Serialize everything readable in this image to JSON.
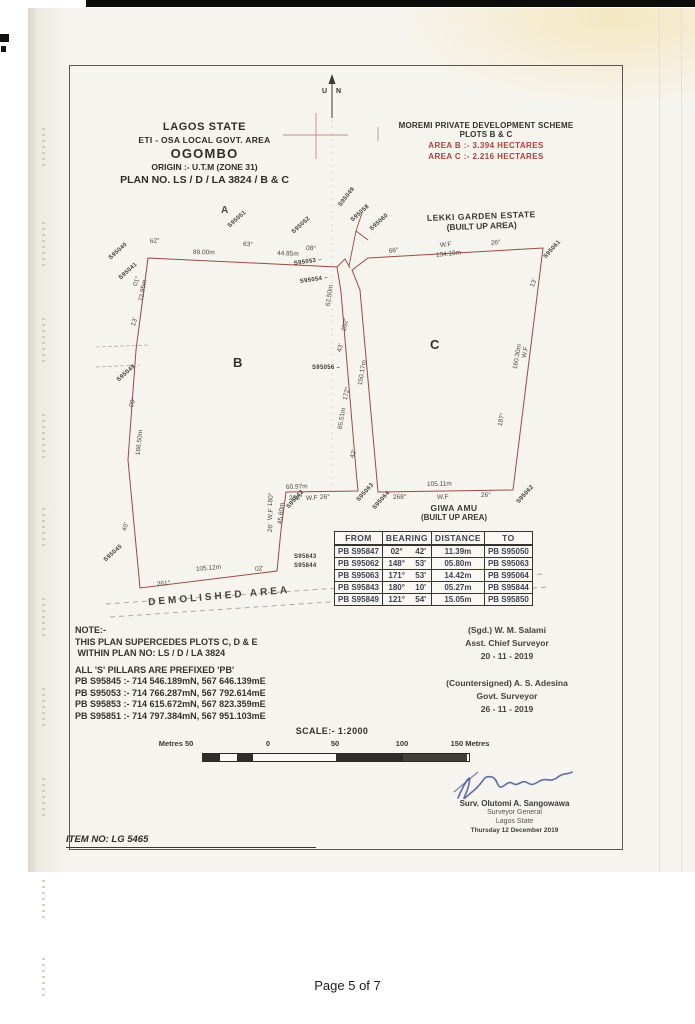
{
  "page": {
    "footer": "Page 5 of 7",
    "item_no": "ITEM NO: LG 5465"
  },
  "header_left": {
    "lines": [
      "LAGOS STATE",
      "ETI - OSA  LOCAL GOVT. AREA",
      "OGOMBO",
      "ORIGIN :- U.T.M (ZONE 31)",
      "PLAN NO. LS / D / LA 3824 / B & C"
    ]
  },
  "header_right": {
    "line1": "MOREMI PRIVATE DEVELOPMENT SCHEME",
    "line2": "PLOTS B & C",
    "area_b": "AREA  B :- 3.394 HECTARES",
    "area_c": "AREA  C :- 2.216 HECTARES",
    "red_color": "#b0413a"
  },
  "north": {
    "u": "U",
    "n": "N"
  },
  "map": {
    "plot_b": "B",
    "plot_c": "C",
    "estate_line1": "LEKKI GARDEN ESTATE",
    "estate_line2": "(BUILT UP AREA)",
    "giwa_line1": "GIWA AMU",
    "giwa_line2": "(BUILT UP AREA)",
    "demolished": "DEMOLISHED  AREA",
    "line_color": "#9b4a42",
    "labels": [
      {
        "t": "A",
        "x": 221,
        "y": 206,
        "r": 0,
        "f": 10,
        "b": 1
      },
      {
        "t": "62°",
        "x": 150,
        "y": 239,
        "r": -4
      },
      {
        "t": "89.00m",
        "x": 193,
        "y": 250,
        "r": 1
      },
      {
        "t": "63°",
        "x": 243,
        "y": 242,
        "r": 2
      },
      {
        "t": "44.85m",
        "x": 277,
        "y": 251,
        "r": 2
      },
      {
        "t": "08°",
        "x": 306,
        "y": 246,
        "r": 2
      },
      {
        "t": "S95051",
        "x": 229,
        "y": 224,
        "r": -42,
        "p": 1
      },
      {
        "t": "S95052",
        "x": 293,
        "y": 230,
        "r": -42,
        "p": 1
      },
      {
        "t": "S95049",
        "x": 340,
        "y": 203,
        "r": -52,
        "p": 1
      },
      {
        "t": "S95058",
        "x": 352,
        "y": 218,
        "r": -42,
        "p": 1
      },
      {
        "t": "S95053 –",
        "x": 294,
        "y": 261,
        "r": -8,
        "p": 1
      },
      {
        "t": "S95054 –",
        "x": 300,
        "y": 279,
        "r": -8,
        "p": 1
      },
      {
        "t": "S95060",
        "x": 371,
        "y": 227,
        "r": -42,
        "p": 1
      },
      {
        "t": "S95061",
        "x": 545,
        "y": 255,
        "r": -48,
        "p": 1
      },
      {
        "t": "S95040",
        "x": 110,
        "y": 256,
        "r": -42,
        "p": 1
      },
      {
        "t": "S95041",
        "x": 120,
        "y": 276,
        "r": -42,
        "p": 1
      },
      {
        "t": "01°",
        "x": 136,
        "y": 283,
        "r": -72
      },
      {
        "t": "72.95m",
        "x": 142,
        "y": 298,
        "r": -80
      },
      {
        "t": "13'",
        "x": 134,
        "y": 323,
        "r": -72
      },
      {
        "t": "S95049",
        "x": 118,
        "y": 378,
        "r": -42,
        "p": 1
      },
      {
        "t": "00'",
        "x": 132,
        "y": 404,
        "r": -72
      },
      {
        "t": "166.50m",
        "x": 139,
        "y": 452,
        "r": -84
      },
      {
        "t": "40'",
        "x": 125,
        "y": 528,
        "r": -72
      },
      {
        "t": "S95045",
        "x": 105,
        "y": 558,
        "r": -42,
        "p": 1
      },
      {
        "t": "105.12m",
        "x": 196,
        "y": 567,
        "r": -5
      },
      {
        "t": "261°",
        "x": 157,
        "y": 582,
        "r": -5
      },
      {
        "t": "02'",
        "x": 255,
        "y": 567,
        "r": -5
      },
      {
        "t": "180°",
        "x": 271,
        "y": 503,
        "r": -84
      },
      {
        "t": "W.F",
        "x": 271,
        "y": 517,
        "r": -84
      },
      {
        "t": "26'",
        "x": 271,
        "y": 529,
        "r": -84
      },
      {
        "t": "45.60m",
        "x": 281,
        "y": 521,
        "r": -84
      },
      {
        "t": "S95042",
        "x": 288,
        "y": 505,
        "r": -48,
        "p": 1
      },
      {
        "t": "S95843",
        "x": 294,
        "y": 554,
        "r": 0,
        "p": 1
      },
      {
        "t": "S95844",
        "x": 294,
        "y": 563,
        "r": 0,
        "p": 1
      },
      {
        "t": "60.97m",
        "x": 286,
        "y": 485,
        "r": -2
      },
      {
        "t": "268°",
        "x": 289,
        "y": 496,
        "r": -2
      },
      {
        "t": "W.F",
        "x": 306,
        "y": 496,
        "r": -2
      },
      {
        "t": "26°",
        "x": 320,
        "y": 495,
        "r": -2
      },
      {
        "t": "S95063",
        "x": 358,
        "y": 498,
        "r": -48,
        "p": 1
      },
      {
        "t": "S95064",
        "x": 374,
        "y": 506,
        "r": -48,
        "p": 1
      },
      {
        "t": "105.11m",
        "x": 427,
        "y": 482,
        "r": -1
      },
      {
        "t": "268°",
        "x": 393,
        "y": 495,
        "r": -1
      },
      {
        "t": "W.F",
        "x": 437,
        "y": 495,
        "r": -1
      },
      {
        "t": "26°",
        "x": 481,
        "y": 493,
        "r": -1
      },
      {
        "t": "S95062",
        "x": 518,
        "y": 500,
        "r": -48,
        "p": 1
      },
      {
        "t": "62.50m",
        "x": 329,
        "y": 303,
        "r": -82
      },
      {
        "t": "202°",
        "x": 345,
        "y": 328,
        "r": -80
      },
      {
        "t": "43'",
        "x": 340,
        "y": 349,
        "r": -74
      },
      {
        "t": "S95056 –",
        "x": 312,
        "y": 365,
        "r": 0,
        "p": 1
      },
      {
        "t": "150.17m",
        "x": 361,
        "y": 382,
        "r": -80
      },
      {
        "t": "172°",
        "x": 346,
        "y": 397,
        "r": -78
      },
      {
        "t": "65.51m",
        "x": 341,
        "y": 426,
        "r": -80
      },
      {
        "t": "42'",
        "x": 353,
        "y": 455,
        "r": -74
      },
      {
        "t": "66°",
        "x": 389,
        "y": 249,
        "r": -8
      },
      {
        "t": "W.F",
        "x": 440,
        "y": 243,
        "r": -6
      },
      {
        "t": "134.19m",
        "x": 436,
        "y": 253,
        "r": -6
      },
      {
        "t": "26°",
        "x": 491,
        "y": 241,
        "r": -6
      },
      {
        "t": "13'",
        "x": 533,
        "y": 284,
        "r": -70
      },
      {
        "t": "W.F",
        "x": 525,
        "y": 355,
        "r": -78
      },
      {
        "t": "160.30m",
        "x": 516,
        "y": 366,
        "r": -80
      },
      {
        "t": "187°",
        "x": 501,
        "y": 423,
        "r": -78
      }
    ]
  },
  "table": {
    "headers": [
      "FROM",
      "BEARING",
      "DISTANCE",
      "TO"
    ],
    "rows": [
      [
        "PB S95847",
        "02°",
        "42'",
        "11.39m",
        "PB S95050"
      ],
      [
        "PB S95062",
        "148°",
        "53'",
        "05.80m",
        "PB S95063"
      ],
      [
        "PB S95063",
        "171°",
        "53'",
        "14.42m",
        "PB S95064"
      ],
      [
        "PB S95843",
        "180°",
        "10'",
        "05.27m",
        "PB S95844"
      ],
      [
        "PB S95849",
        "121°",
        "54'",
        "15.05m",
        "PB S95850"
      ]
    ]
  },
  "note": {
    "lines": [
      "NOTE:-",
      "THIS PLAN SUPERCEDES PLOTS C, D & E",
      " WITHIN PLAN NO: LS / D / LA 3824",
      "",
      "ALL 'S' PILLARS ARE PREFIXED 'PB'",
      "PB S95845 :- 714 546.189mN, 567 646.139mE",
      "PB S95053 :- 714 766.287mN, 567 792.614mE",
      "PB S95853 :- 714 615.672mN, 567 823.359mE",
      "PB S95851 :- 714 797.384mN, 567 951.103mE"
    ]
  },
  "signatures": {
    "block1": [
      "(Sgd.) W. M. Salami",
      "Asst. Chief Surveyor",
      "20 - 11 - 2019"
    ],
    "block2": [
      "(Countersigned) A. S. Adesina",
      "Govt. Surveyor",
      "26 - 11 - 2019"
    ]
  },
  "scale": {
    "title": "SCALE:- 1:2000",
    "ticks": [
      "Metres 50",
      "0",
      "50",
      "100",
      "150 Metres"
    ]
  },
  "stamp": {
    "name": "Surv. Olutomi A. Sangowawa",
    "title1": "Surveyor General",
    "title2": "Lagos State",
    "date": "Thursday 12 December 2019",
    "ink_color": "#44549e"
  }
}
